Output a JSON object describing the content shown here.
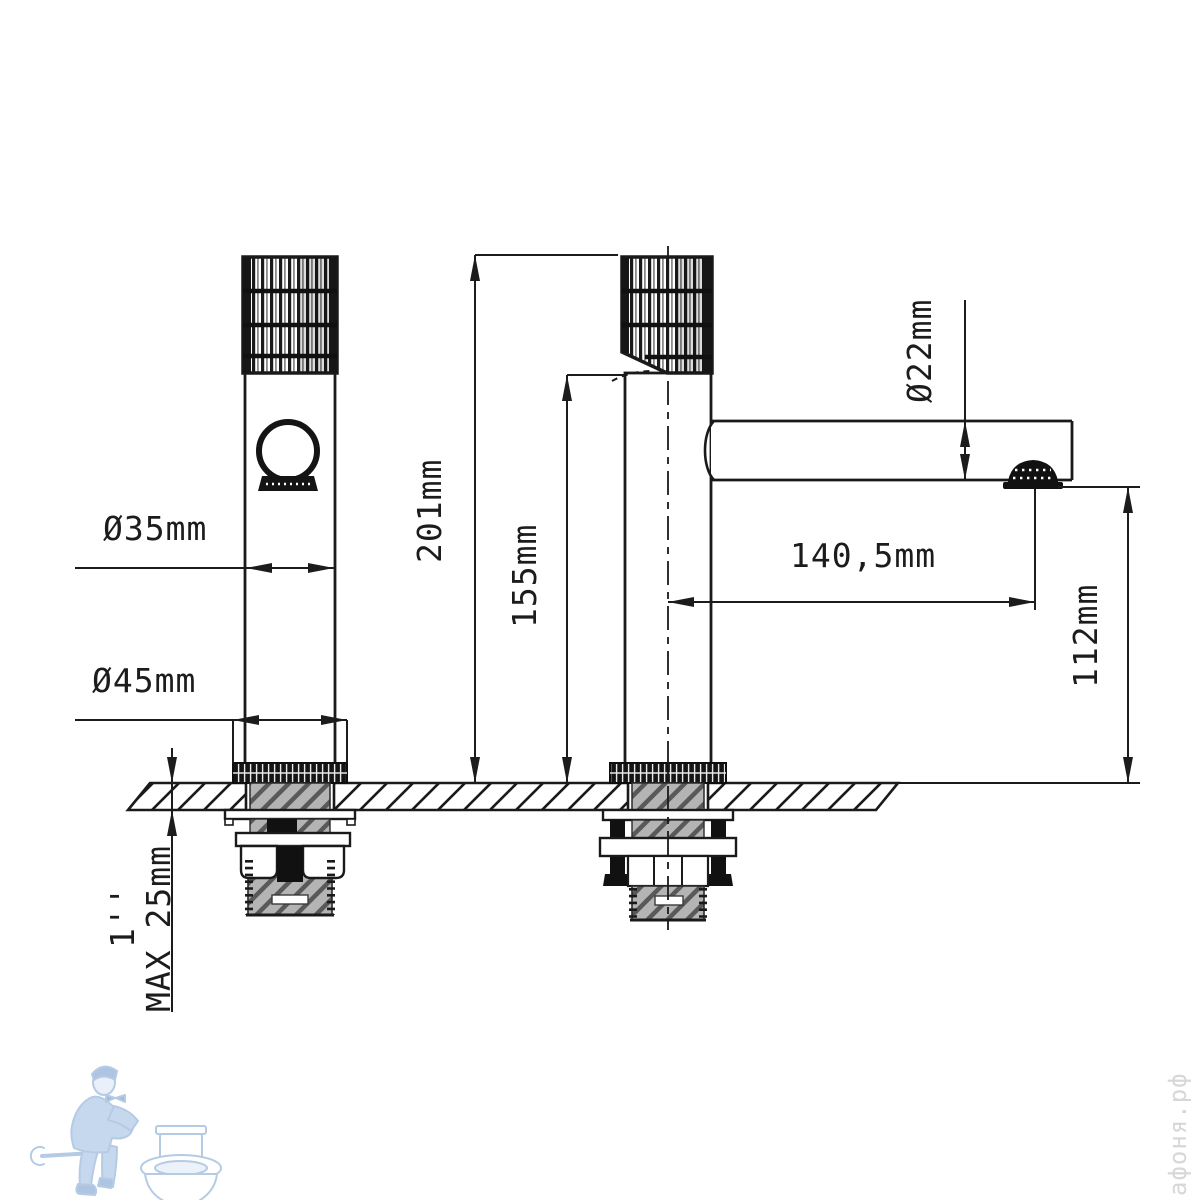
{
  "drawing": {
    "type": "faucet-installation-dimension-drawing",
    "views": {
      "front_view": "faucet front view",
      "side_view": "faucet side view with spout"
    },
    "dimensions": {
      "body_diameter": "Ø35mm",
      "base_diameter": "Ø45mm",
      "total_height": "201mm",
      "body_height": "155mm",
      "spout_diameter": "Ø22mm",
      "spout_reach": "140,5mm",
      "spout_height": "112mm",
      "max_deck_thickness": "MAX 25mm",
      "thread_size": "1''"
    },
    "colors": {
      "line": "#1c1c1c",
      "thread_fill": "#b4b4b4",
      "logo_blue": "#aac4e2",
      "watermark_gray": "#d7d7d7"
    }
  },
  "watermark": {
    "site_text": "афоня.рф",
    "logo": "plumber-with-toilet"
  }
}
